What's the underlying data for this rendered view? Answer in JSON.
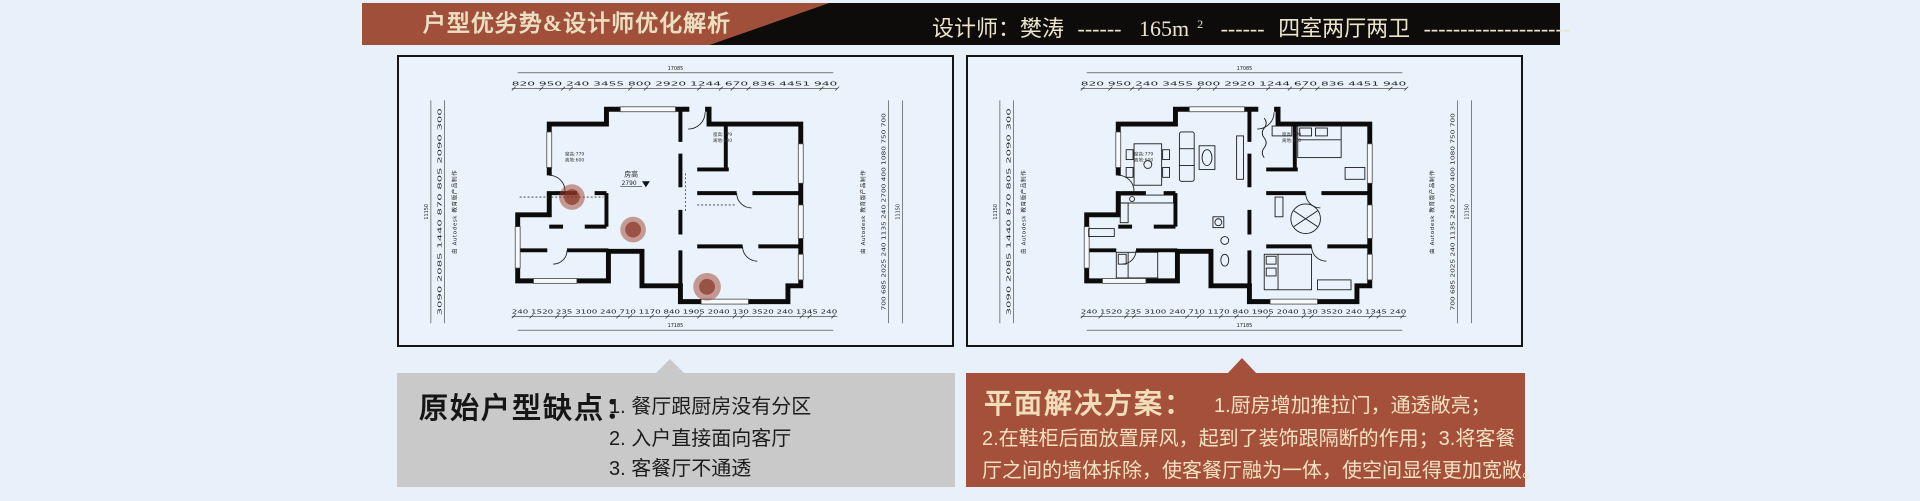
{
  "header": {
    "title": "户型优劣势&设计师优化解析",
    "designer": "设计师：樊涛",
    "dash_a": "------",
    "area_base": "165m",
    "area_exp": "2",
    "dash_b": "------",
    "layout": "四室两厅两卫",
    "dash_c": "--------------------"
  },
  "plan_common": {
    "top_total": "17085",
    "top_dims": "820 950 240  3455   800   2920   1244  670 836   4451  940",
    "bottom_dims": "240 1520 235  3100  240 710 1170 840  1905  2040 130  3520 240 1345 240",
    "bottom_total": "17185",
    "left_dims": "3090  2085  1440 870  805  2090 300",
    "right_dims": "700 685  2025 240 1135 240  2700 400  1080 750 700",
    "side_total": "11150",
    "watermark": "由 Autodesk 教育版产品制作",
    "ceiling_label": "房高",
    "ceiling_value": "2790",
    "window_note_1": "窗高:779",
    "window_note_2": "离地:600"
  },
  "defects": {
    "heading": "原始户型缺点：",
    "item1": "1. 餐厅跟厨房没有分区",
    "item2": "2. 入户直接面向客厅",
    "item3": "3. 客餐厅不通透"
  },
  "solution": {
    "heading": "平面解决方案：",
    "point1": "1.厨房增加推拉门，通透敞亮；",
    "line2": "2.在鞋柜后面放置屏风，起到了装饰跟隔断的作用；3.将客餐",
    "line3": "厅之间的墙体拆除，使客餐厅融为一体，使空间显得更加宽敞。"
  },
  "colors": {
    "page_bg": "#e8f1f9",
    "banner_red": "#a0503a",
    "banner_black": "#0d0c0a",
    "banner_text": "#ecdfc1",
    "defects_bg": "#c9c9c9",
    "solution_bg": "#a5503a",
    "solution_text": "#f2e2c2"
  }
}
